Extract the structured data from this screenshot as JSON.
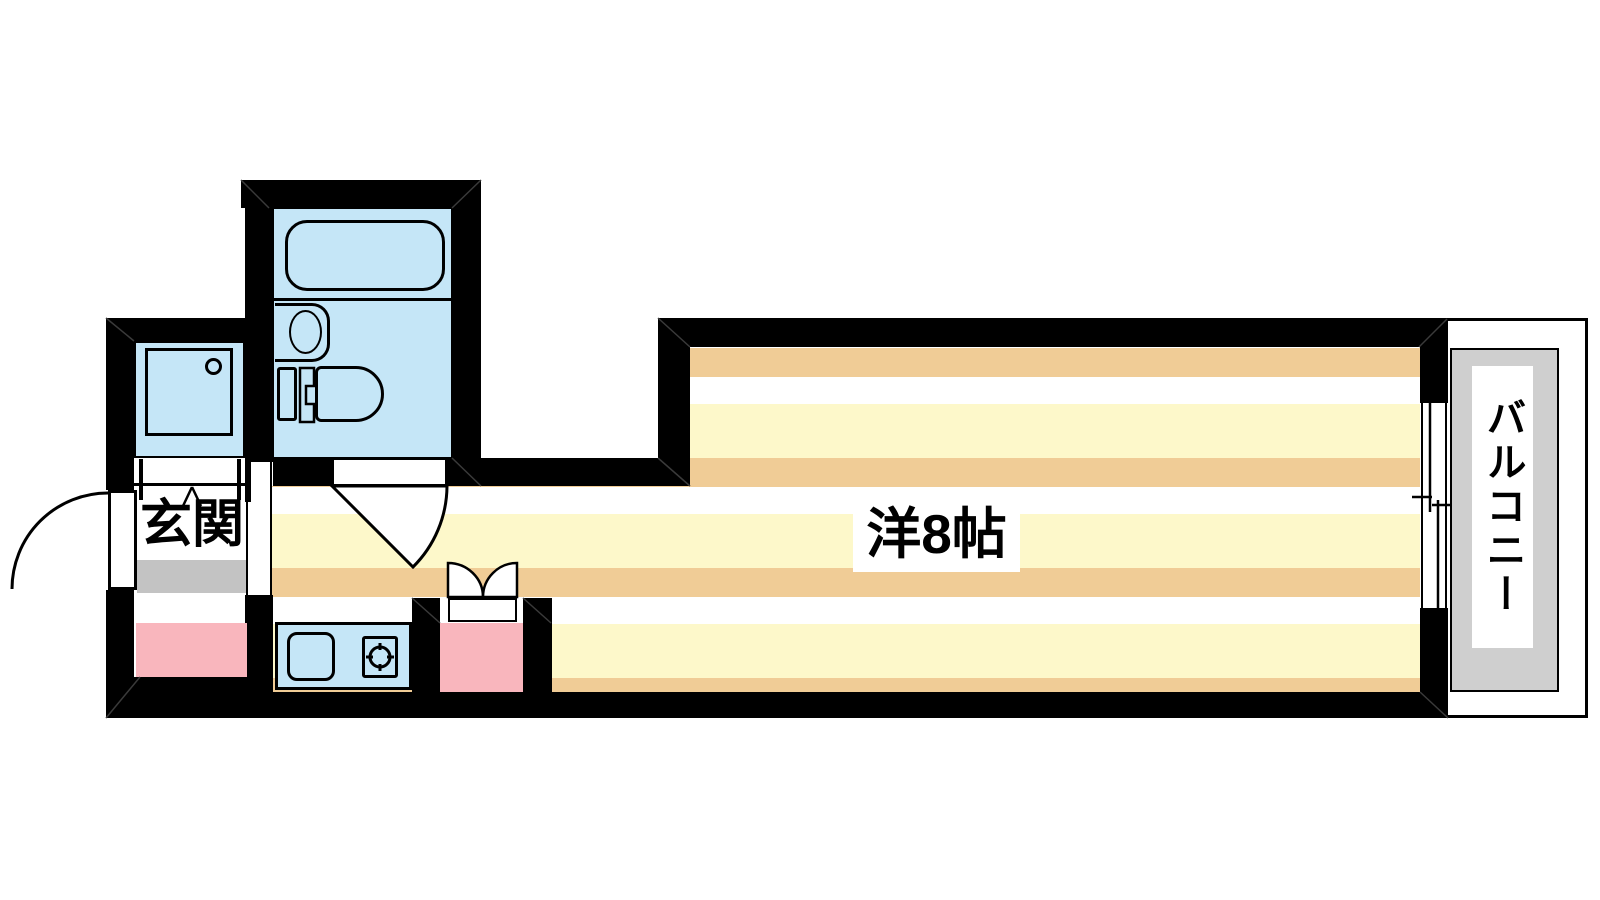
{
  "floorplan": {
    "type": "apartment-floor-plan",
    "rooms": {
      "entrance_label": "玄関",
      "main_room_label": "洋8帖",
      "balcony_label": "バルコニー"
    },
    "fixtures": [
      "bathtub",
      "wash-basin",
      "toilet",
      "shower-pan",
      "kitchen-sink",
      "stove-burner",
      "entrance-door-swing",
      "bathroom-door-swing",
      "bifold-door",
      "sliding-window",
      "genkan-step",
      "utility-space"
    ],
    "colors": {
      "wall": "#000000",
      "floor_tan": "#f0cc96",
      "floor_yellow": "#fdf8ca",
      "fixture_blue": "#c5e6f7",
      "pink": "#f9b6bd",
      "step_gray": "#c3c3c3",
      "balcony_gray": "#cfcfcf",
      "background": "#ffffff"
    }
  }
}
